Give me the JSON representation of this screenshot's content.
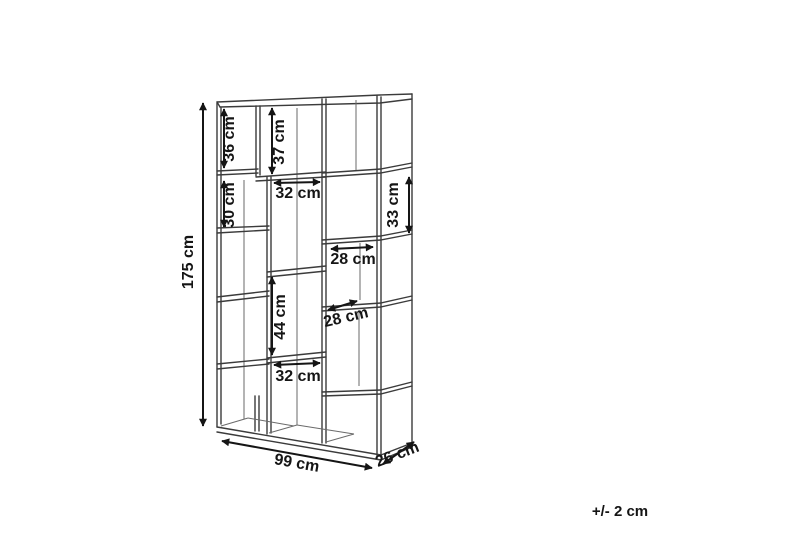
{
  "diagram": {
    "type": "furniture-dimension-drawing",
    "subject": "bookshelf",
    "unit": "cm",
    "overall": {
      "height_label": "175 cm",
      "width_label": "99 cm",
      "depth_label": "26 cm"
    },
    "compartments": {
      "cell_36_label": "36 cm",
      "cell_37_label": "37 cm",
      "cell_30_label": "30 cm",
      "cell_33_label": "33 cm",
      "cell_32_top_label": "32 cm",
      "cell_28_upper_label": "28 cm",
      "cell_28_lower_label": "28 cm",
      "cell_44_label": "44 cm",
      "cell_32_bottom_label": "32 cm"
    },
    "tolerance_note": "+/- 2 cm",
    "colors": {
      "background": "#ffffff",
      "structure_line": "#3b3b3b",
      "hidden_line": "#6a6a6a",
      "dimension_ink": "#151515"
    }
  }
}
